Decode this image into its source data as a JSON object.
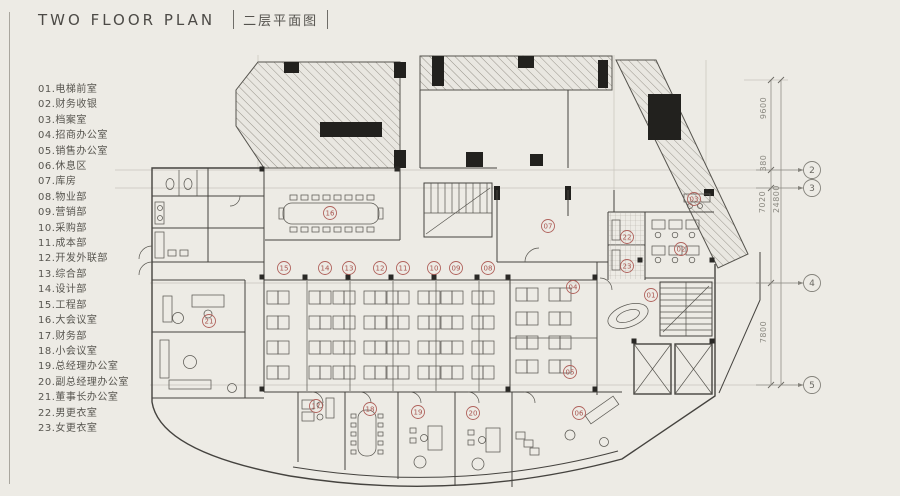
{
  "title": {
    "en": "TWO FLOOR PLAN",
    "zh": "二层平面图"
  },
  "legend": {
    "items": [
      "01.电梯前室",
      "02.财务收银",
      "03.档案室",
      "04.招商办公室",
      "05.销售办公室",
      "06.休息区",
      "07.库房",
      "08.物业部",
      "09.营销部",
      "10.采购部",
      "11.成本部",
      "12.开发外联部",
      "13.综合部",
      "14.设计部",
      "15.工程部",
      "16.大会议室",
      "17.财务部",
      "18.小会议室",
      "19.总经理办公室",
      "20.副总经理办公室",
      "21.董事长办公室",
      "22.男更衣室",
      "23.女更衣室"
    ]
  },
  "plan": {
    "room_markers": [
      {
        "id": "16",
        "x": 330,
        "y": 213
      },
      {
        "id": "07",
        "x": 548,
        "y": 226
      },
      {
        "id": "03",
        "x": 694,
        "y": 199
      },
      {
        "id": "22",
        "x": 627,
        "y": 237
      },
      {
        "id": "23",
        "x": 627,
        "y": 266
      },
      {
        "id": "02",
        "x": 681,
        "y": 249
      },
      {
        "id": "01",
        "x": 651,
        "y": 295
      },
      {
        "id": "04",
        "x": 573,
        "y": 287
      },
      {
        "id": "05",
        "x": 570,
        "y": 372
      },
      {
        "id": "15",
        "x": 284,
        "y": 268
      },
      {
        "id": "14",
        "x": 325,
        "y": 268
      },
      {
        "id": "13",
        "x": 349,
        "y": 268
      },
      {
        "id": "12",
        "x": 380,
        "y": 268
      },
      {
        "id": "11",
        "x": 403,
        "y": 268
      },
      {
        "id": "10",
        "x": 434,
        "y": 268
      },
      {
        "id": "09",
        "x": 456,
        "y": 268
      },
      {
        "id": "08",
        "x": 488,
        "y": 268
      },
      {
        "id": "21",
        "x": 209,
        "y": 321
      },
      {
        "id": "17",
        "x": 316,
        "y": 406
      },
      {
        "id": "18",
        "x": 370,
        "y": 409
      },
      {
        "id": "19",
        "x": 418,
        "y": 412
      },
      {
        "id": "20",
        "x": 473,
        "y": 413
      },
      {
        "id": "06",
        "x": 579,
        "y": 413
      }
    ],
    "grid_bubbles": [
      {
        "id": "2",
        "x": 812,
        "y": 170
      },
      {
        "id": "3",
        "x": 812,
        "y": 188
      },
      {
        "id": "4",
        "x": 812,
        "y": 283
      },
      {
        "id": "5",
        "x": 812,
        "y": 385
      }
    ],
    "dimensions": [
      {
        "label": "9600",
        "x": 766,
        "y": 108
      },
      {
        "label": "380",
        "x": 766,
        "y": 163
      },
      {
        "label": "7020",
        "x": 765,
        "y": 202
      },
      {
        "label": "7800",
        "x": 766,
        "y": 332
      },
      {
        "label": "24800",
        "x": 779,
        "y": 199
      }
    ]
  },
  "colors": {
    "background": "#edebe5",
    "wall": "#45433f",
    "marker": "#b0625c",
    "marker_text": "#a8534d",
    "grid": "#85837c",
    "dimension_text": "#8a8880"
  }
}
